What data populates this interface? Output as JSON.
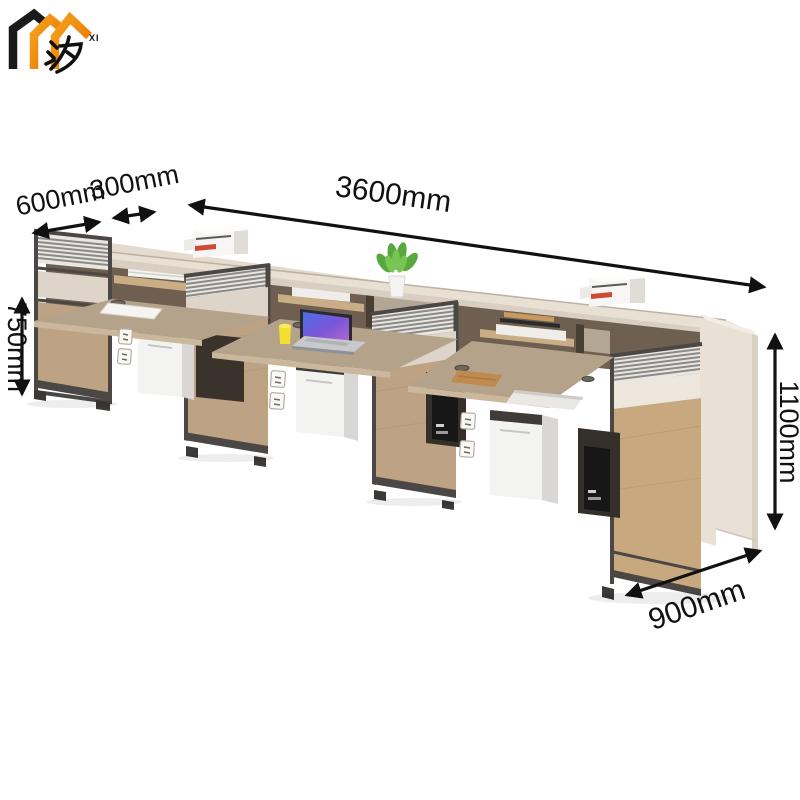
{
  "page": {
    "background": "#ffffff",
    "kind": "furniture-product-dimension-image"
  },
  "logo": {
    "character": "汐",
    "subtext": "XI",
    "colors": {
      "black": "#1a1a1a",
      "orange_light": "#f6a21c",
      "orange_dark": "#e86f00"
    }
  },
  "dimensions": {
    "labels": {
      "desk_depth": "600mm",
      "shelf_depth": "300mm",
      "total_length": "3600mm",
      "desk_height": "750mm",
      "total_height": "1100mm",
      "side_depth": "900mm"
    },
    "arrow_color": "#111111"
  },
  "scene": {
    "furniture": "Three-seat staff office workstation row with overhead cubby hutch, louvered divider screens, wood modesty panels and under-desk cabinets",
    "items": [
      "printer-left",
      "paper-stack",
      "books-with-glasses",
      "potted-plant",
      "books",
      "printer-right",
      "document-sheet",
      "laptop-open",
      "yellow-mug",
      "wood-notebook",
      "laptop-closed",
      "pc-tower",
      "power-outlets",
      "cable-grommets"
    ],
    "colors": {
      "counter_top": "#e4dbce",
      "counter_face": "#d8cec1",
      "hutch_interior": "#5c4e40",
      "shelf_wood": "#c9ad85",
      "desk_wood": "#b5a28a",
      "desk_edge": "#cbb89c",
      "panel_wood": "#c1a27d",
      "frame_dark": "#4a4745",
      "screen_fill": "#e8e7e4",
      "screen_slat": "#8c8a85",
      "beige_panel": "#ddd5ca",
      "end_panel": "#e9e1d6",
      "cabinet_white": "#f3f3f2",
      "laptop_screen": "#5a5fd4"
    }
  }
}
